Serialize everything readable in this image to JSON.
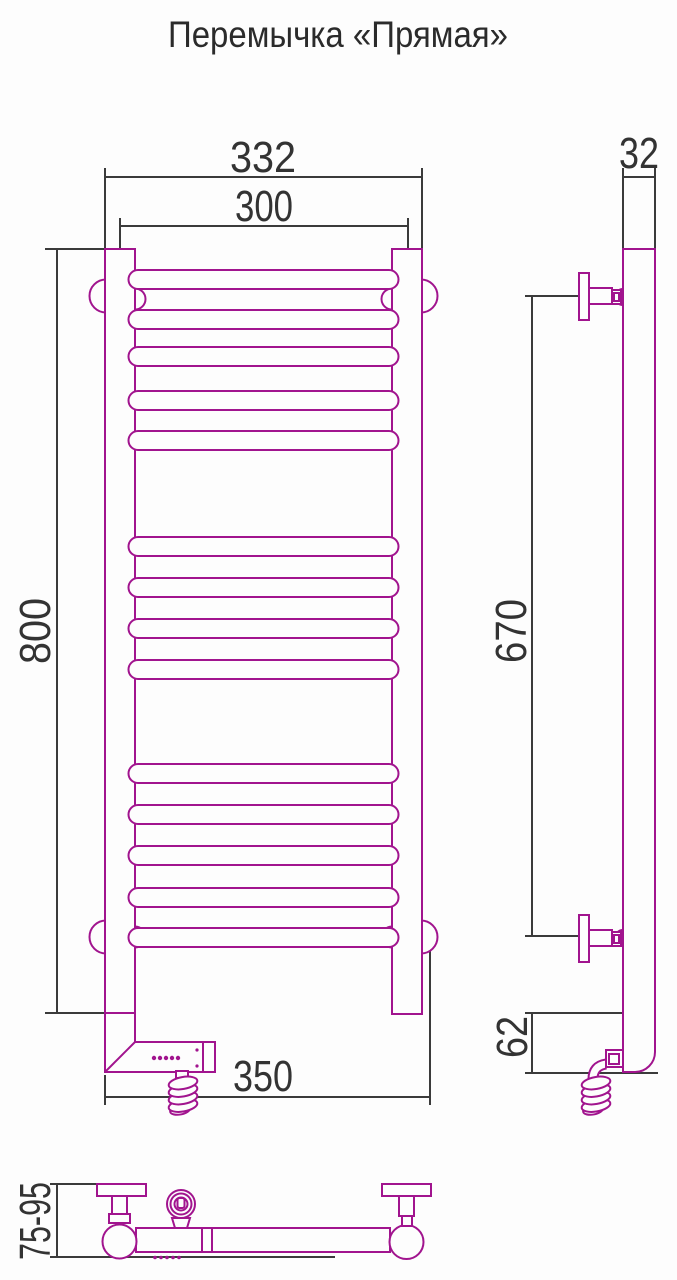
{
  "title": "Перемычка «Прямая»",
  "views": {
    "front": {
      "dims": {
        "overall_width": "332",
        "rail_span": "300",
        "height": "800",
        "bottom_width": "350"
      },
      "rail_count": 14
    },
    "side": {
      "dims": {
        "depth": "32",
        "mount_span": "670",
        "bottom_offset": "62"
      }
    },
    "top": {
      "dims": {
        "wall_distance": "75-95"
      }
    }
  },
  "colors": {
    "product_line": "#A1148E",
    "dimension_line": "#3B3B3B",
    "dimension_text": "#333333",
    "background": "#FDFDFD"
  }
}
